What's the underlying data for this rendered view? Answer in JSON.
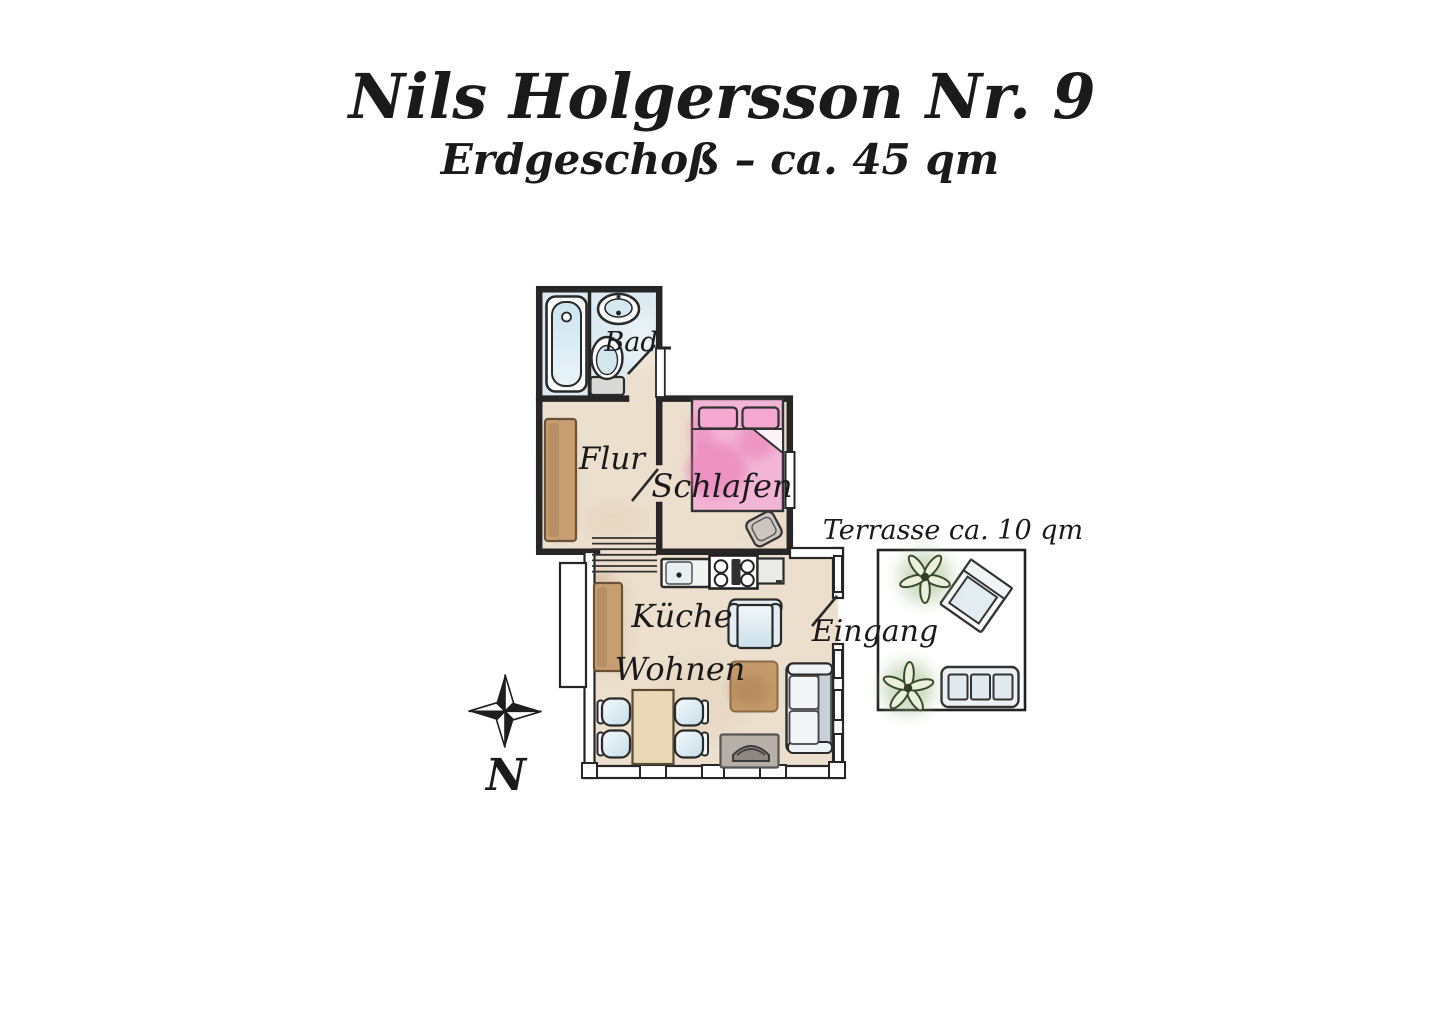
{
  "header": {
    "title": "Nils Holgersson Nr. 9",
    "subtitle": "Erdgeschoß – ca. 45 qm"
  },
  "rooms": {
    "bad": {
      "label": "Bad"
    },
    "flur": {
      "label": "Flur"
    },
    "schlafen": {
      "label": "Schlafen"
    },
    "kueche": {
      "label": "Küche"
    },
    "wohnen": {
      "label": "Wohnen"
    },
    "eingang": {
      "label": "Eingang"
    }
  },
  "terrace": {
    "label": "Terrasse ca. 10 qm"
  },
  "compass": {
    "north_label": "N"
  },
  "colors": {
    "wall": "#262626",
    "floor": "#ecdfce",
    "bath_floor": "#dcebf1",
    "bed_pink": "#f3b5d5",
    "wood_brown": "#c79e6f",
    "upholstery_blue": "#d9e8ef",
    "plant_green": "#384d28",
    "ink": "#1a1a1a"
  }
}
